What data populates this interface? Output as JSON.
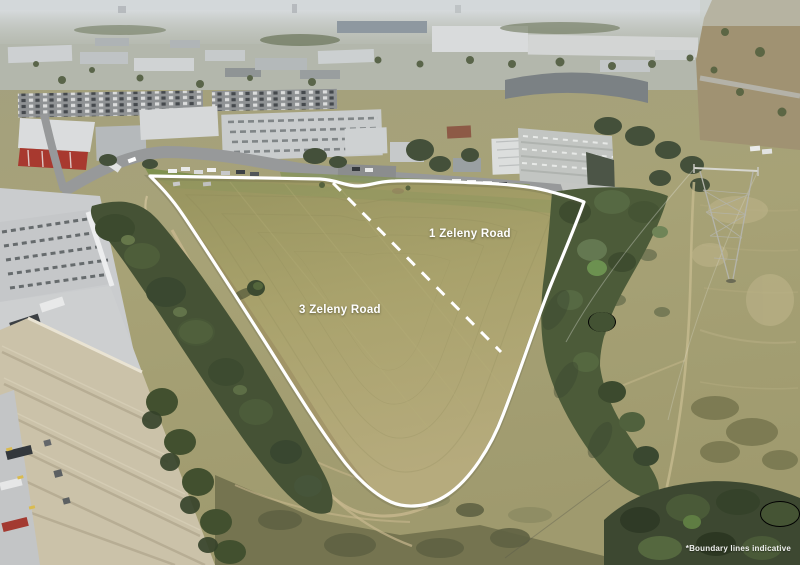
{
  "scene": {
    "description": "Aerial drone photograph of two vacant grass land parcels outlined in white, bordered by an industrial estate, tree belts and scrubland",
    "parcel_labels": {
      "lot_1": "1 Zeleny Road",
      "lot_2": "3 Zeleny Road"
    },
    "disclaimer": "*Boundary lines indicative",
    "colors": {
      "boundary_line": "#ffffff",
      "label_text": "#ffffff",
      "parcel_grass": "#a9a26c",
      "scrubland": "#a7a276",
      "tree_canopy": "#47523a",
      "warehouse_roof_gray": "#c5c7c9",
      "warehouse_roof_beige": "#cbc2a9",
      "road": "#97999a",
      "sky_haze": "#ccd2d4"
    }
  }
}
